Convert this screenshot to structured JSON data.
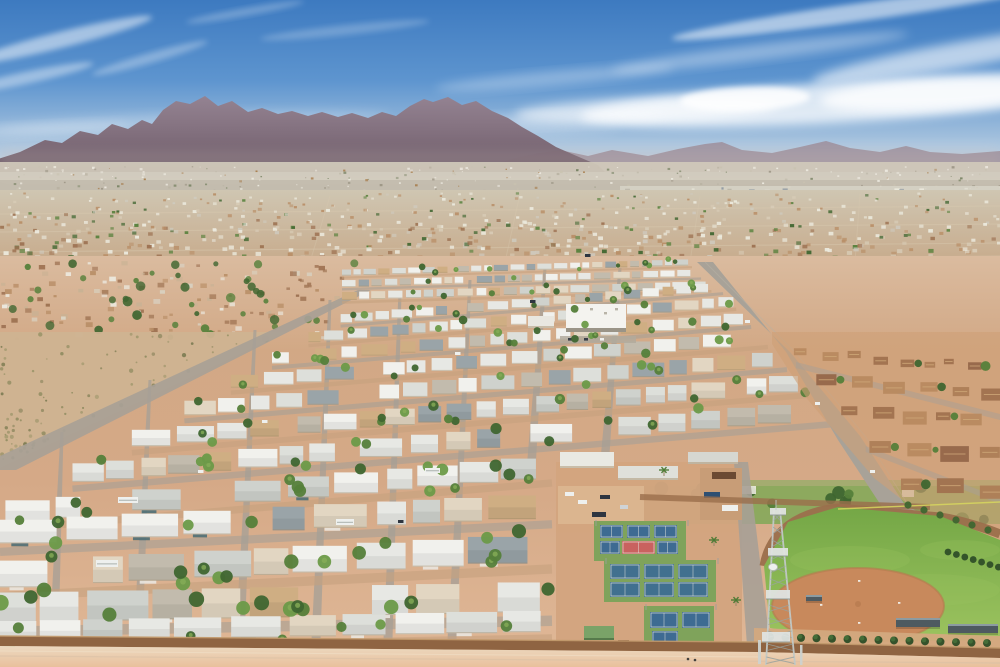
{
  "scene": {
    "type": "aerial-photograph",
    "alt": "Aerial drone photo of a desert mobile-home-park community: mountain range on the horizon, sprawling tan suburbs, grid rows of white-roofed mobile homes, pickleball courts, a softball field, a lattice cell tower and a perimeter wall in the foreground",
    "sky": {
      "top": "#3d7ac0",
      "mid": "#5e95cf",
      "low": "#a9c4de",
      "horizon": "#d2dce6",
      "cloud": "#ffffff"
    },
    "mountains": {
      "main_top": "#958290",
      "main_bottom": "#6b5764",
      "distant": "#9c8b96",
      "base_haze": "#b5a8a6"
    },
    "valley": {
      "haze_band": "#d1cabb",
      "sprawl_near": "#c7a989",
      "sprawl_far": "#cfc6b2",
      "industrial_band": "#d7d3c7",
      "blue_roof": "#3b5c9e"
    },
    "ground": {
      "park_dirt": "#d5a987",
      "park_dirt_light": "#e0b897",
      "open_field": "#cfb391",
      "scrub": "#8d8a5e",
      "street_gray": "#a7a096",
      "street_tan": "#c7a27f",
      "road_main": "#a8a298",
      "road_edge": "#8f8a80"
    },
    "homes": {
      "roof_white": "#f1f1ed",
      "roof_light": "#e7e8e4",
      "roof_mid": "#dddfda",
      "roof_gray": "#cfd2cd",
      "roof_tan": "#cfae83",
      "roof_slate": "#9aa4a8",
      "roof_warm": "#c2bbad",
      "roof_cream": "#e2d6c2",
      "wall_teal": "#4e6f75",
      "shadow": "#a8926f"
    },
    "suburb": {
      "roof_brown": "#a1734f",
      "roof_brown2": "#ad7f58",
      "roof_brown3": "#96684a",
      "roof_brown4": "#b98a60",
      "ground": "#cfa077",
      "ridge": "#cfa878"
    },
    "vegetation": {
      "tree_dark": "#3f6630",
      "tree_mid": "#55803a",
      "tree_light": "#6b9a48",
      "palm_light": "#86ad58",
      "lawn": "#85a95a",
      "hedge": "#2f4f28",
      "hedge_top": "#46703a"
    },
    "recreation": {
      "court_blue": "#3e6b92",
      "court_blue2": "#41708f",
      "court_green": "#7fa35b",
      "court_red": "#c9625f",
      "court_line": "#e8e6df",
      "shed_green": "#7aa368",
      "grass_field": "#7fae4b",
      "grass_light": "#9cc35f",
      "infield_dirt": "#c8895c",
      "infield_edge": "#b5794e",
      "track_brown": "#9b6f4c",
      "foul_line": "#d8d75e",
      "canopy": "#4e5a60",
      "canopy_top": "#93a2a8"
    },
    "structures": {
      "wall_brown": "#8f6442",
      "wall_top": "#c29a6d",
      "outside_light": "#ecd9c0",
      "outside_warm": "#e9c09c",
      "tower_steel": "#c2c9c6",
      "tower_dark": "#9aa39f",
      "community_roof": "#f4f3ef",
      "community_wall": "#8a8274",
      "bldg_metal": "#dfe0da"
    },
    "vehicles": {
      "rv_white": "#eef0ee",
      "car_dark": "#2e3540",
      "truck_blue": "#2e4f72",
      "bin_brown": "#6b4a33"
    },
    "counts": {
      "valley_specks": 260,
      "sprawl_specks": 720,
      "right_specks": 170,
      "hood_specks": 130,
      "hood_trees": 42,
      "scrub_specks": 90,
      "park_trees": 150,
      "suburb_rows": 5,
      "strip_trees": 16,
      "hedges": 15,
      "industrial_specks": 90
    }
  }
}
